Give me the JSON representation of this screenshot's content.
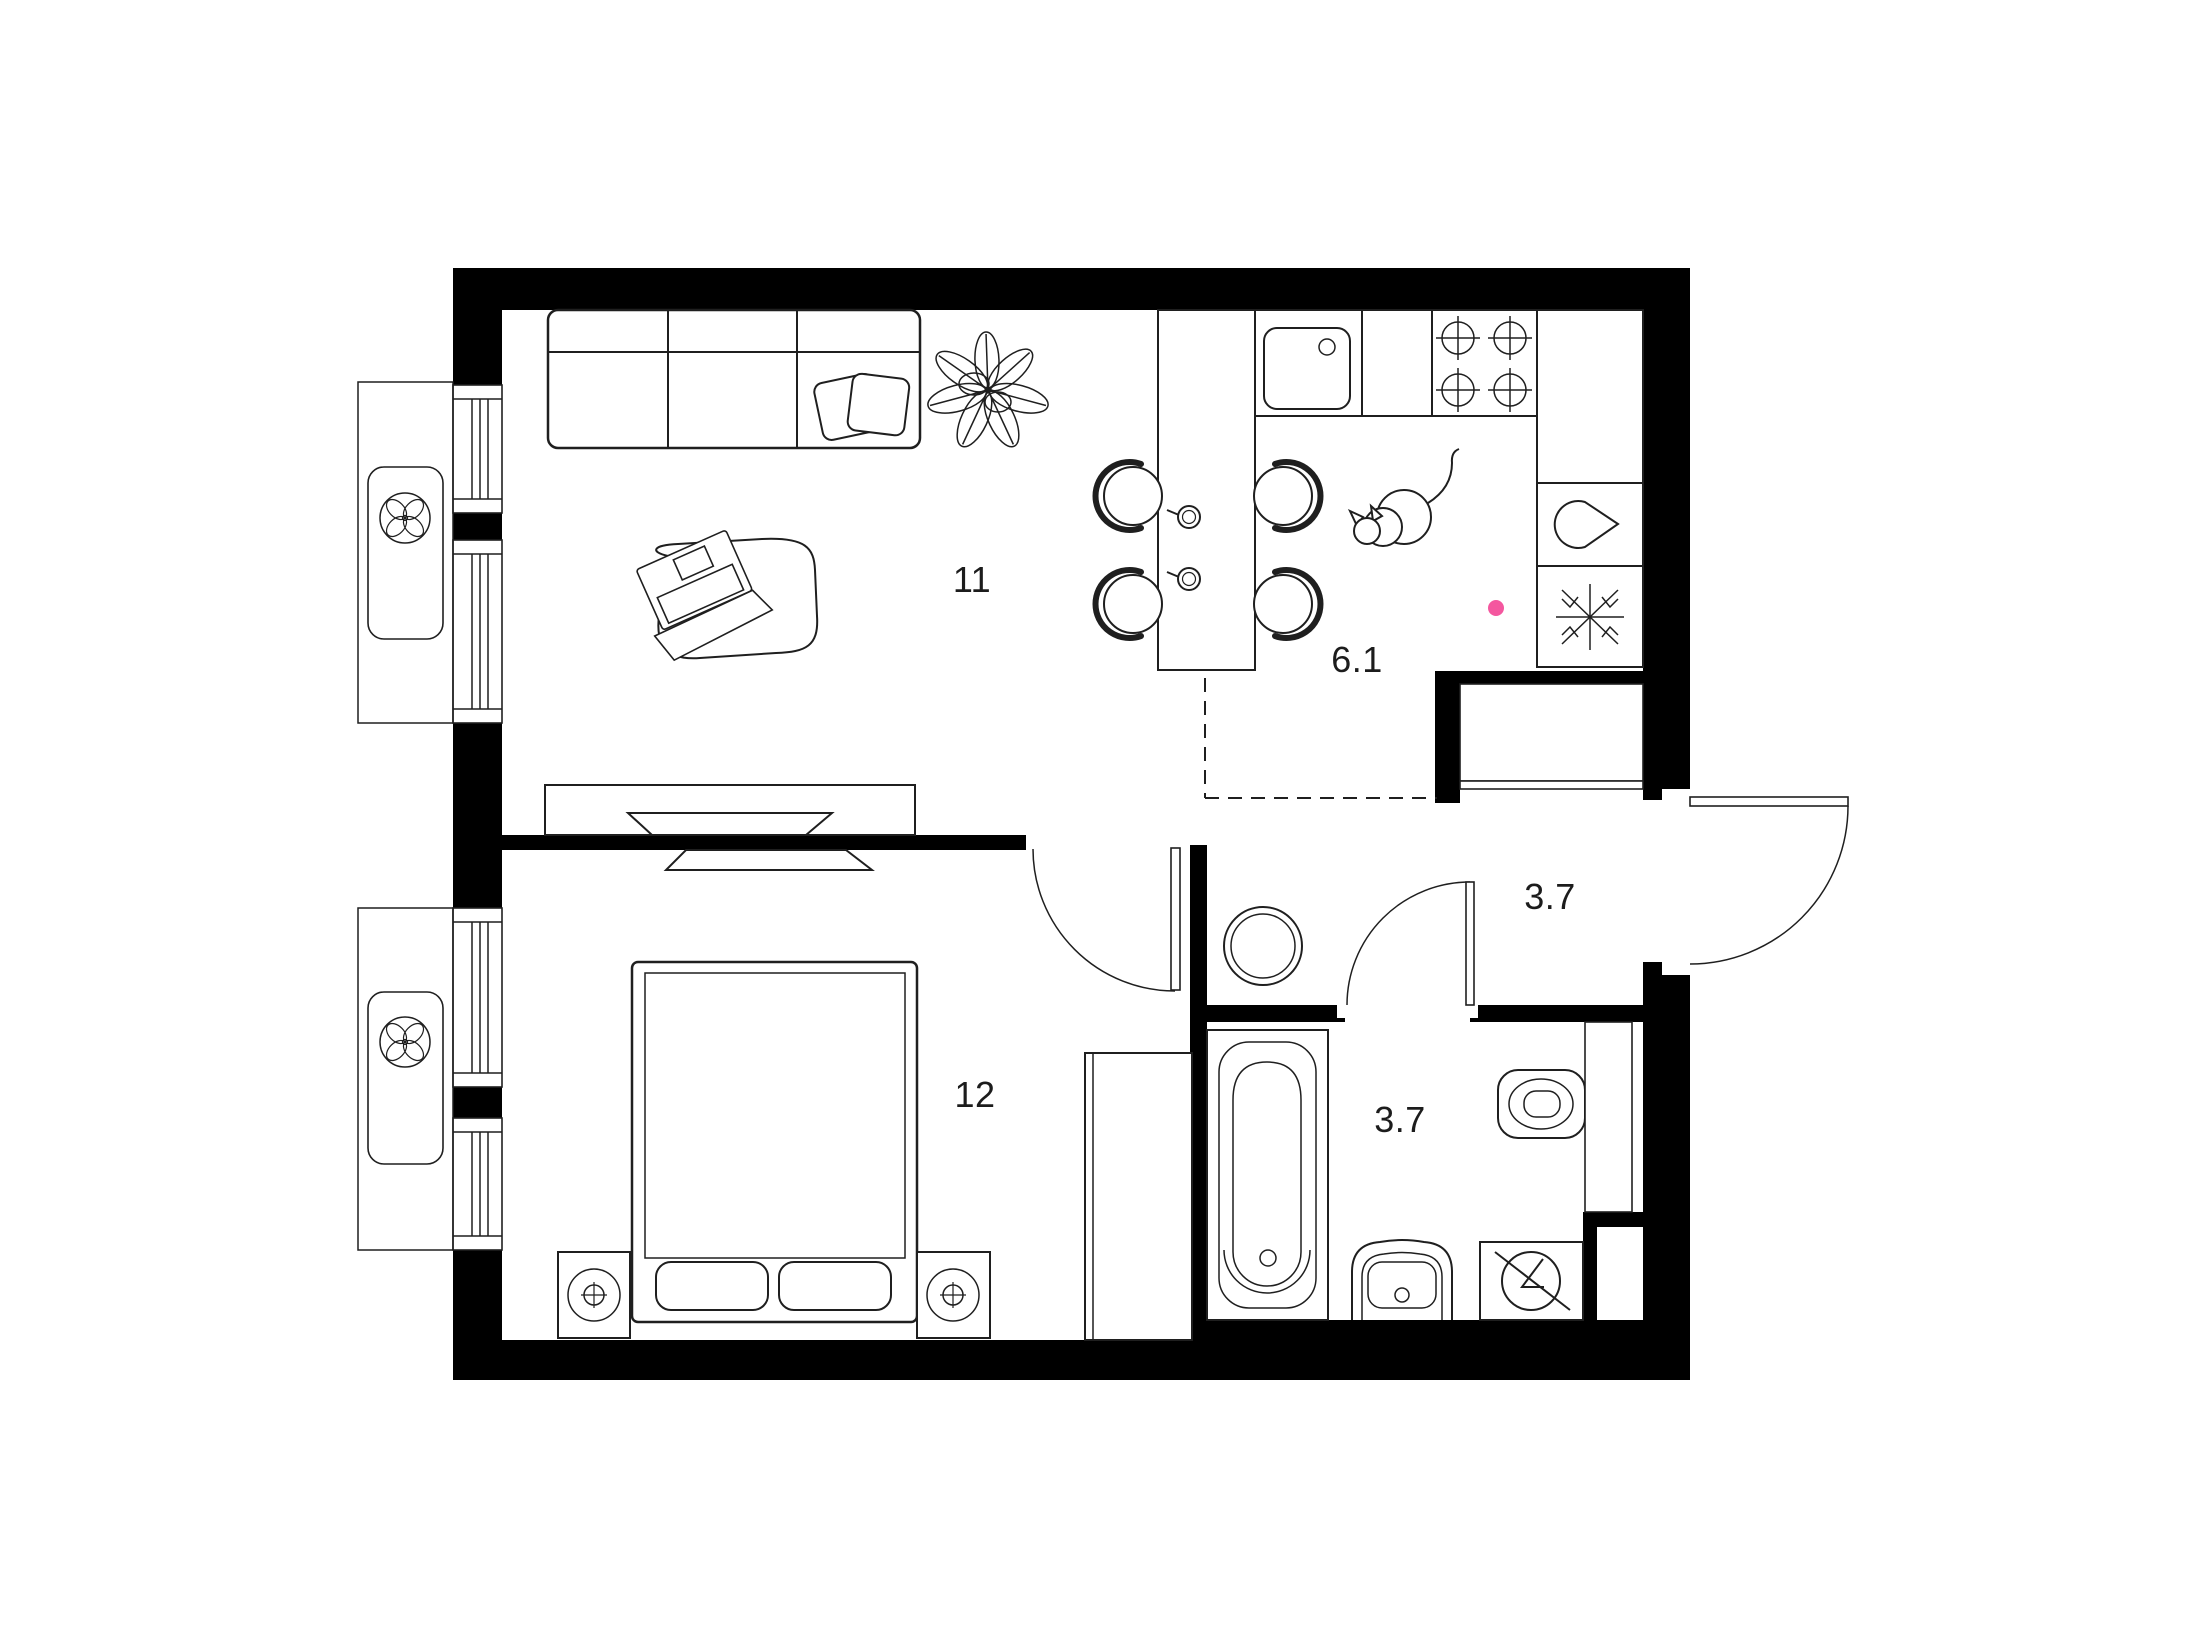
{
  "plan": {
    "type": "apartment-floor-plan",
    "background": "#ffffff",
    "wall_color": "#000000",
    "line_color": "#1f1f1f",
    "accent_color": "#f4579f",
    "rooms": [
      {
        "id": "living-room",
        "area_label": "11"
      },
      {
        "id": "kitchen",
        "area_label": "6.1"
      },
      {
        "id": "bedroom",
        "area_label": "12"
      },
      {
        "id": "hallway",
        "area_label": "3.7"
      },
      {
        "id": "bathroom",
        "area_label": "3.7"
      }
    ],
    "icons": [
      "fan-icon",
      "snowflake-icon",
      "teardrop-icon",
      "stove-burners-icon",
      "kitchen-sink-icon",
      "bathtub-icon",
      "toilet-icon",
      "washing-machine-icon",
      "bathroom-sink-icon",
      "table-lamp-icon",
      "cat-icon",
      "plant-icon",
      "laptop-icon",
      "sofa-icon",
      "bed-icon",
      "tv-icon",
      "dining-chair-icon",
      "cup-icon",
      "boiler-icon",
      "door-swing-icon",
      "window-icon",
      "accent-dot-icon"
    ]
  }
}
